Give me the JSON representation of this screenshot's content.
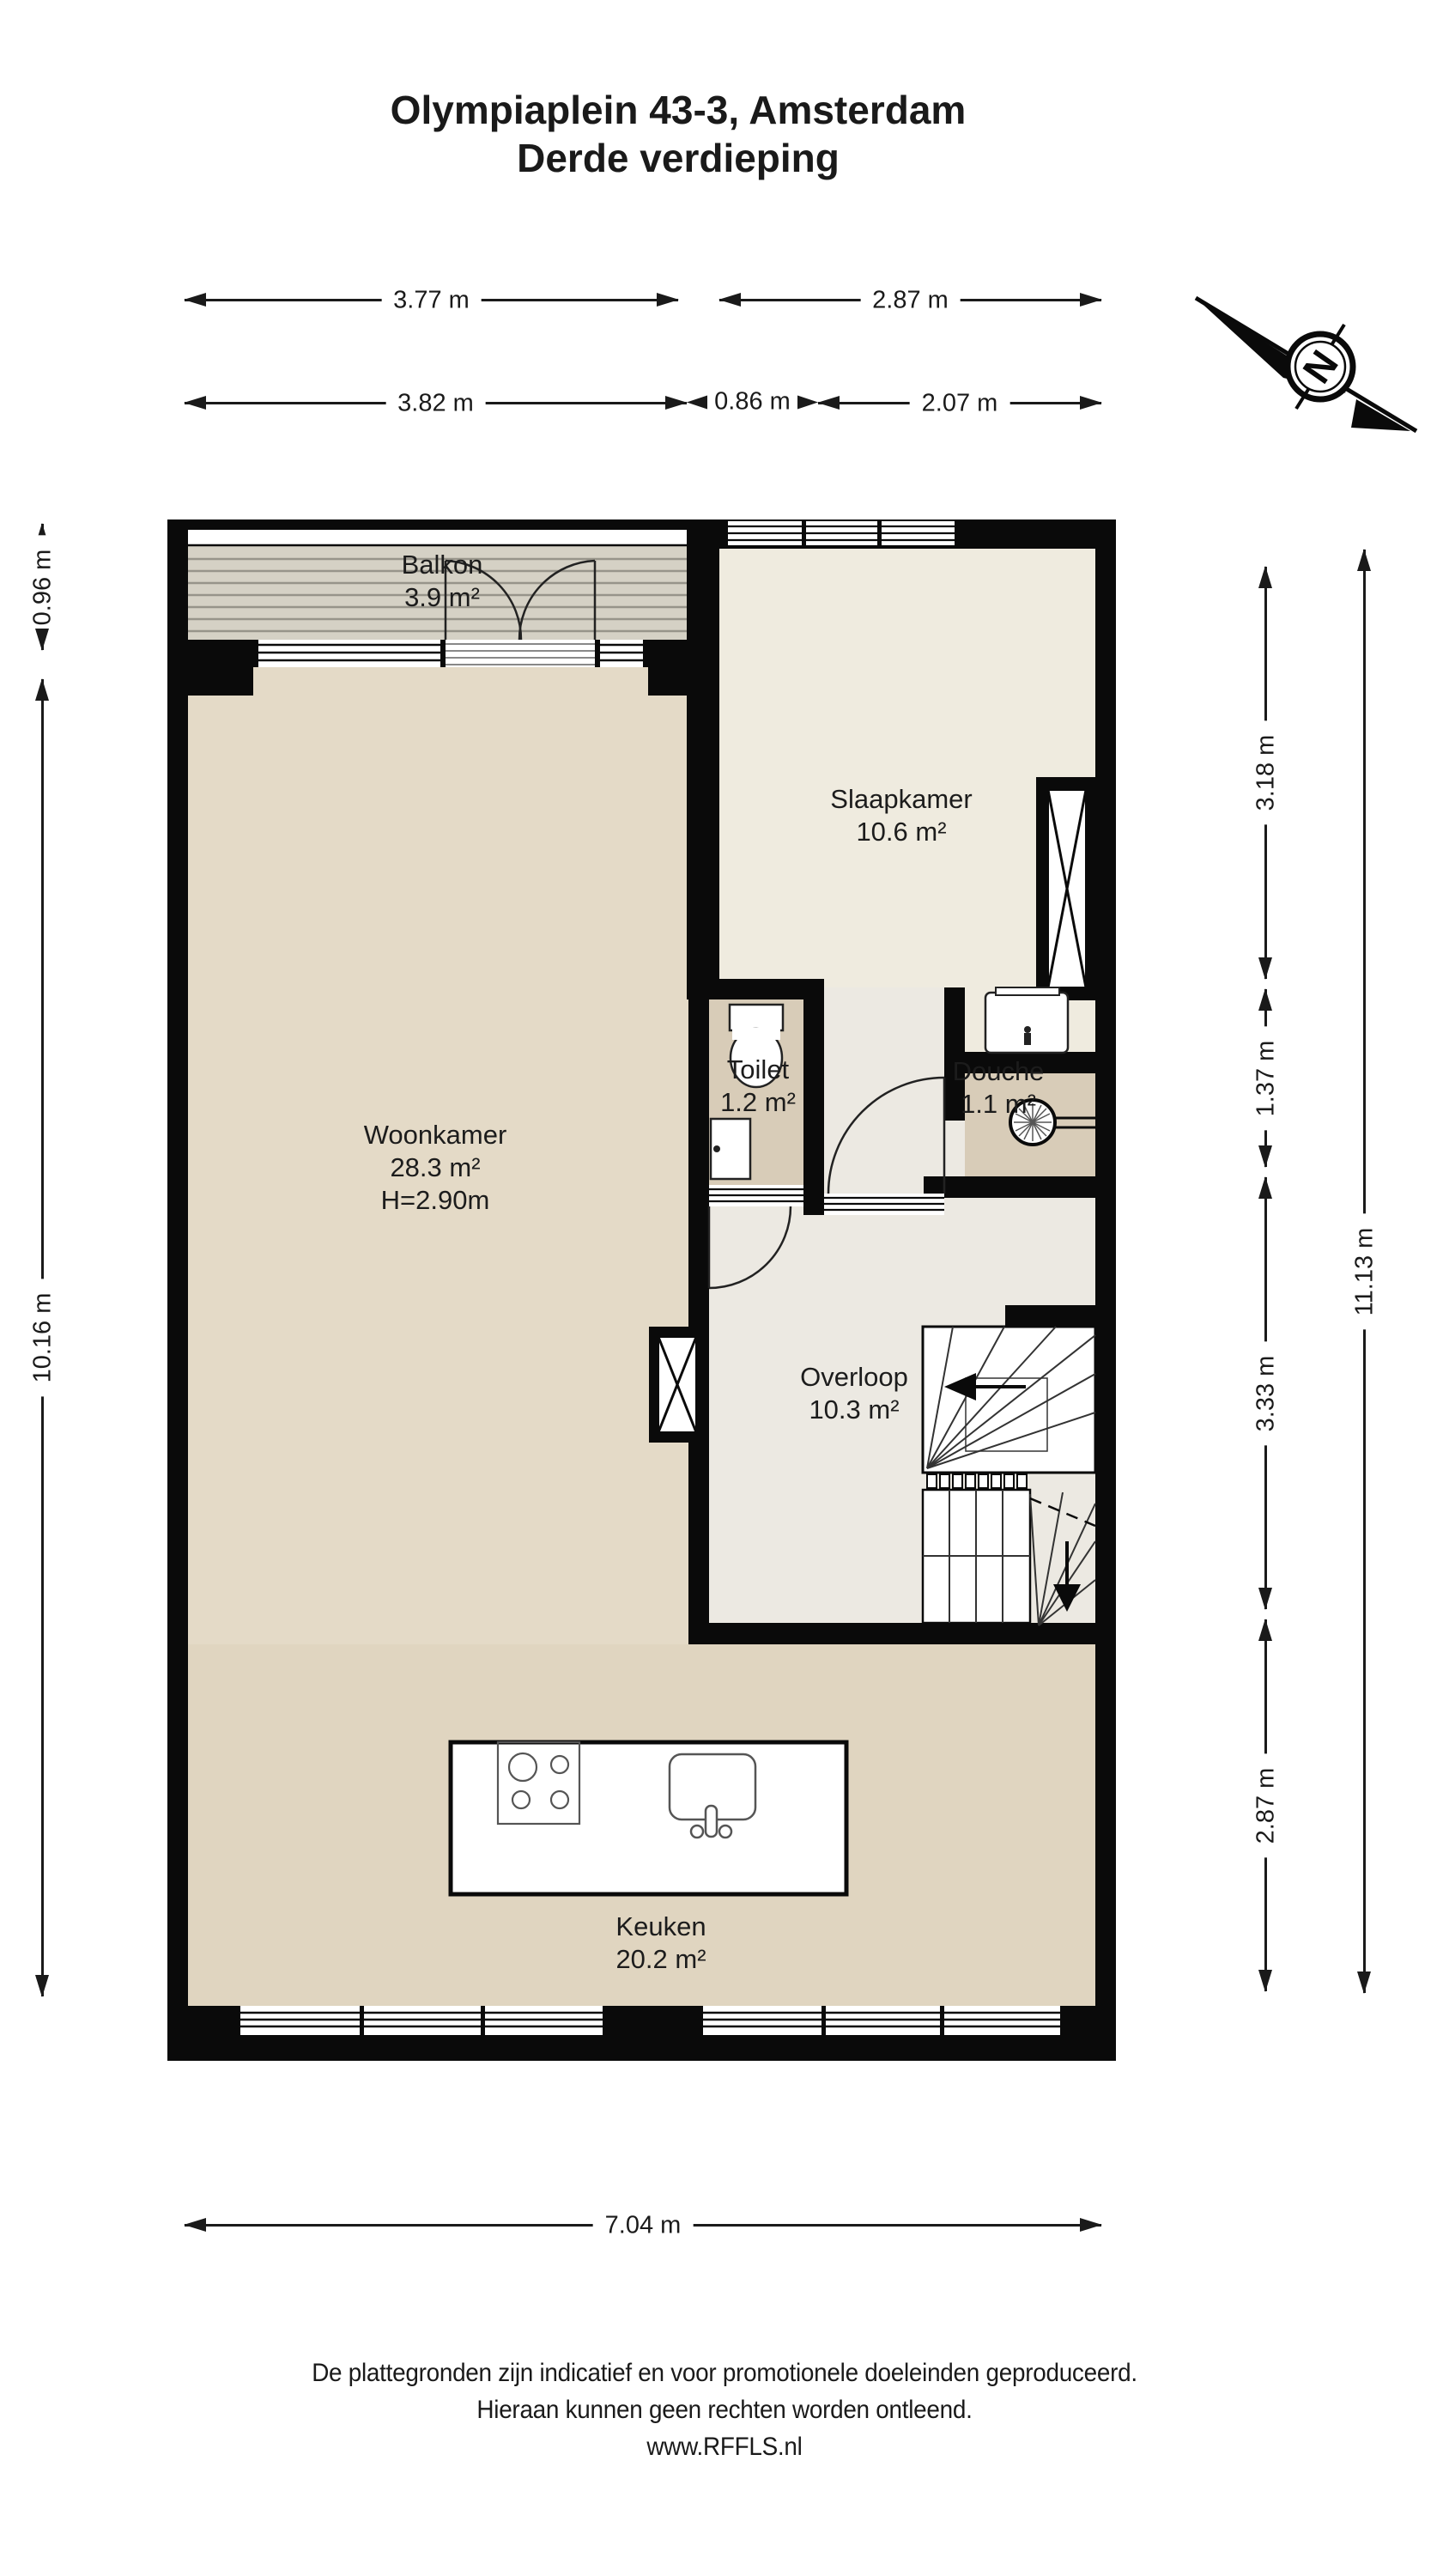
{
  "title": {
    "line1": "Olympiaplein 43-3, Amsterdam",
    "line2": "Derde verdieping"
  },
  "compass": {
    "label": "N"
  },
  "dims": {
    "top_377": "3.77 m",
    "top_287": "2.87 m",
    "top_382": "3.82 m",
    "top_086": "0.86 m",
    "top_207": "2.07 m",
    "left_096": "0.96 m",
    "left_1016": "10.16 m",
    "right_318": "3.18 m",
    "right_137": "1.37 m",
    "right_333": "3.33 m",
    "right_287": "2.87 m",
    "right_1113": "11.13 m",
    "bottom_704": "7.04 m"
  },
  "rooms": {
    "balkon": {
      "name": "Balkon",
      "area": "3.9 m²"
    },
    "slaapkamer": {
      "name": "Slaapkamer",
      "area": "10.6 m²"
    },
    "woonkamer": {
      "name": "Woonkamer",
      "area": "28.3 m²",
      "height": "H=2.90m"
    },
    "toilet": {
      "name": "Toilet",
      "area": "1.2 m²"
    },
    "douche": {
      "name": "Douche",
      "area": "1.1 m²"
    },
    "overloop": {
      "name": "Overloop",
      "area": "10.3 m²"
    },
    "keuken": {
      "name": "Keuken",
      "area": "20.2 m²"
    }
  },
  "footer": {
    "line1": "De plattegronden zijn indicatief en voor promotionele doeleinden geproduceerd.",
    "line2": "Hieraan kunnen geen rechten worden ontleend.",
    "line3": "www.RFFLS.nl"
  },
  "colors": {
    "wall": "#0a0a0a",
    "woonkamer_floor": "#E4DAC7",
    "keuken_floor": "#E0D5C0",
    "slaapkamer_floor": "#EFEBDF",
    "overloop_floor": "#ECE9E2",
    "sanitair_floor": "#D8CCB8",
    "balkon_deck": "#D5D1C5",
    "dimension_line": "#1a1a1a"
  }
}
